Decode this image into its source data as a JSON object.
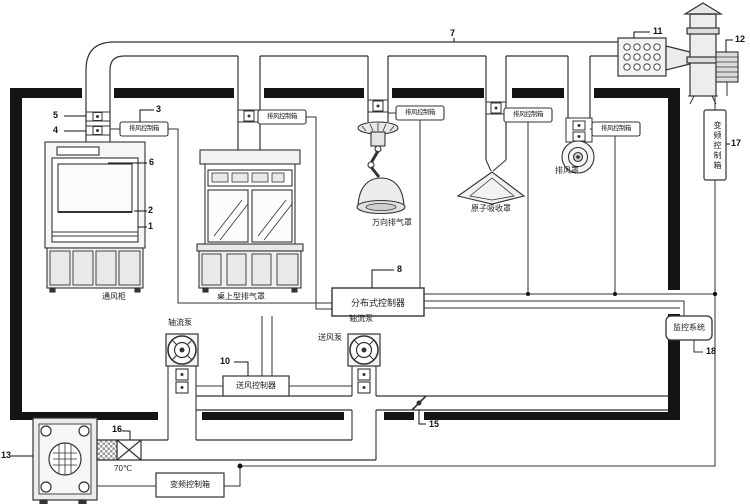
{
  "labels": {
    "fume_hood": "通风柜",
    "desktop_hood": "桌上型排气罩",
    "universal_hood": "万向排气罩",
    "atomic_hood": "原子吸收罩",
    "exhaust_hood": "排风罩",
    "axial_fan_left": "轴流泵",
    "axial_fan_right": "轴流泵",
    "supply_fan": "送风泵",
    "exhaust_ctrl_box": "排风控制箱",
    "distributed_controller": "分布式控制器",
    "supply_controller": "送风控制器",
    "vfd_box": "变频控制箱",
    "vfd_box_right": "变频控制箱",
    "monitoring_system": "监控系统",
    "fire_damper_temp": "70℃"
  },
  "ref_numbers": {
    "n1": "1",
    "n2": "2",
    "n3": "3",
    "n4": "4",
    "n5": "5",
    "n6": "6",
    "n7": "7",
    "n8": "8",
    "n10": "10",
    "n11": "11",
    "n12": "12",
    "n13": "13",
    "n15": "15",
    "n16": "16",
    "n17": "17",
    "n18": "18"
  }
}
